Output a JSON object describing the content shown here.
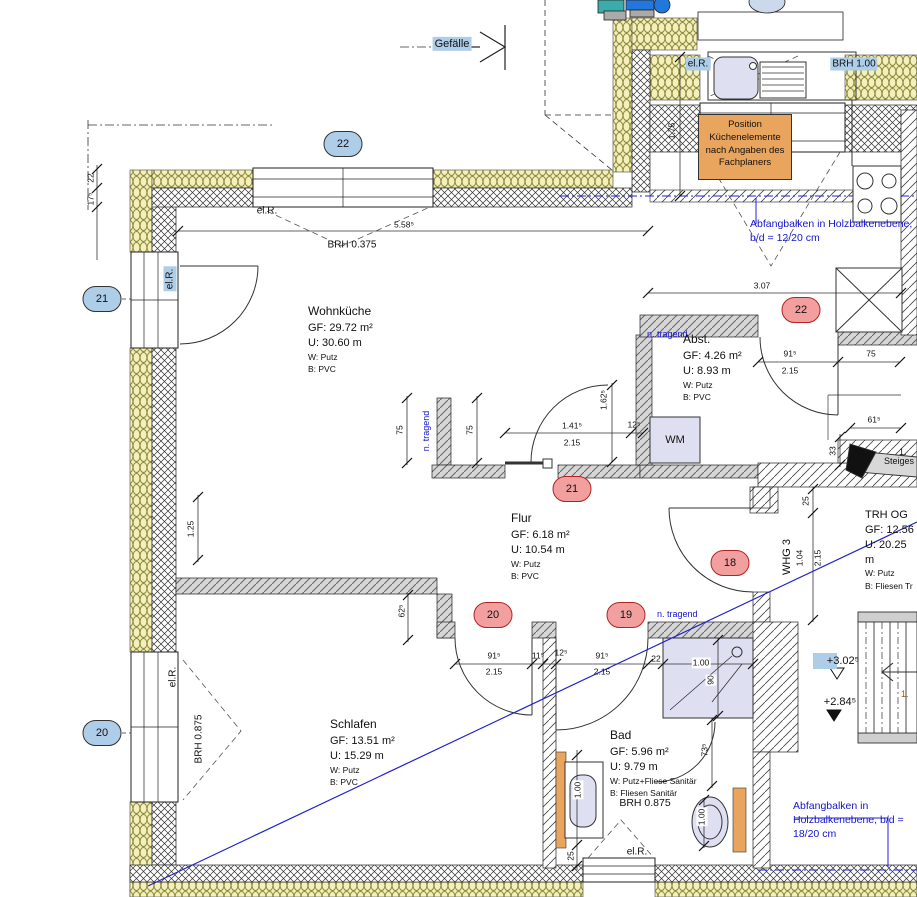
{
  "colors": {
    "hlblue": "#aecde8",
    "hlred": "#f29f9f",
    "orange": "#e9a55e",
    "bluenote": "#1414cc",
    "fixture": "#dfdff2",
    "insulation": "#f5f0bb"
  },
  "drawing": {
    "notes": {
      "gefaelle": "Gefälle",
      "position_box": "Position\nKüchenelemente\nnach Angaben des\nFachplaners",
      "abfangbalken_top": "Abfangbalken in\nHolzbalkenebene,\nb/d = 12/20 cm",
      "abfangbalken_bottom": "Abfangbalken in\nHolzbalkenebene,\nb/d = 18/20 cm",
      "n_tragend": "n. tragend",
      "steigestrang": "Steiges",
      "whg": "WHG 3",
      "wm": "WM",
      "el_r": "el.R.",
      "cut_number": "1."
    },
    "brh": {
      "v100": "BRH 1.00",
      "v0375": "BRH 0.375",
      "v0875": "BRH 0.875"
    },
    "rooms": {
      "wohnkueche": {
        "name": "Wohnküche",
        "gf": "GF: 29.72 m²",
        "u": "U: 30.60 m",
        "w": "W: Putz",
        "b": "B: PVC"
      },
      "abst": {
        "name": "Abst.",
        "gf": "GF: 4.26 m²",
        "u": "U: 8.93 m",
        "w": "W: Putz",
        "b": "B: PVC"
      },
      "flur": {
        "name": "Flur",
        "gf": "GF: 6.18 m²",
        "u": "U: 10.54 m",
        "w": "W: Putz",
        "b": "B: PVC"
      },
      "schlafen": {
        "name": "Schlafen",
        "gf": "GF: 13.51 m²",
        "u": "U: 15.29 m",
        "w": "W: Putz",
        "b": "B: PVC"
      },
      "bad": {
        "name": "Bad",
        "gf": "GF: 5.96 m²",
        "u": "U: 9.79 m",
        "w": "W: Putz+Fliese Sanitär",
        "b": "B: Fliesen Sanitär"
      },
      "trh": {
        "name": "TRH OG",
        "gf": "GF: 12.56",
        "u": "U: 20.25 m",
        "w": "W: Putz",
        "b": "B: Fliesen Tr"
      }
    },
    "axes_blue": {
      "a22": "22",
      "a21": "21",
      "a20": "20"
    },
    "axes_red": {
      "r22": "22",
      "r21": "21",
      "r20": "20",
      "r19": "19",
      "r18": "18"
    },
    "elevations": {
      "upper": "+3.02⁵",
      "lower": "+2.84⁵"
    },
    "dims": {
      "d558": "5.58⁵",
      "d22": "22",
      "d175sup": "17⁵",
      "d1_75": "1,75",
      "d307": "3.07",
      "d915": "91⁵",
      "d215": "2.15",
      "d75": "75",
      "d615": "61⁵",
      "d33": "33",
      "d1415": "1.41⁵",
      "d125sup": "12⁵",
      "d1625": "1.62⁵",
      "d125": "1.25",
      "d625": "62⁵",
      "d115": "11⁵",
      "d100": "1.00",
      "d90": "90",
      "d735": "73⁵",
      "d25": "25",
      "d104": "1.04"
    }
  }
}
